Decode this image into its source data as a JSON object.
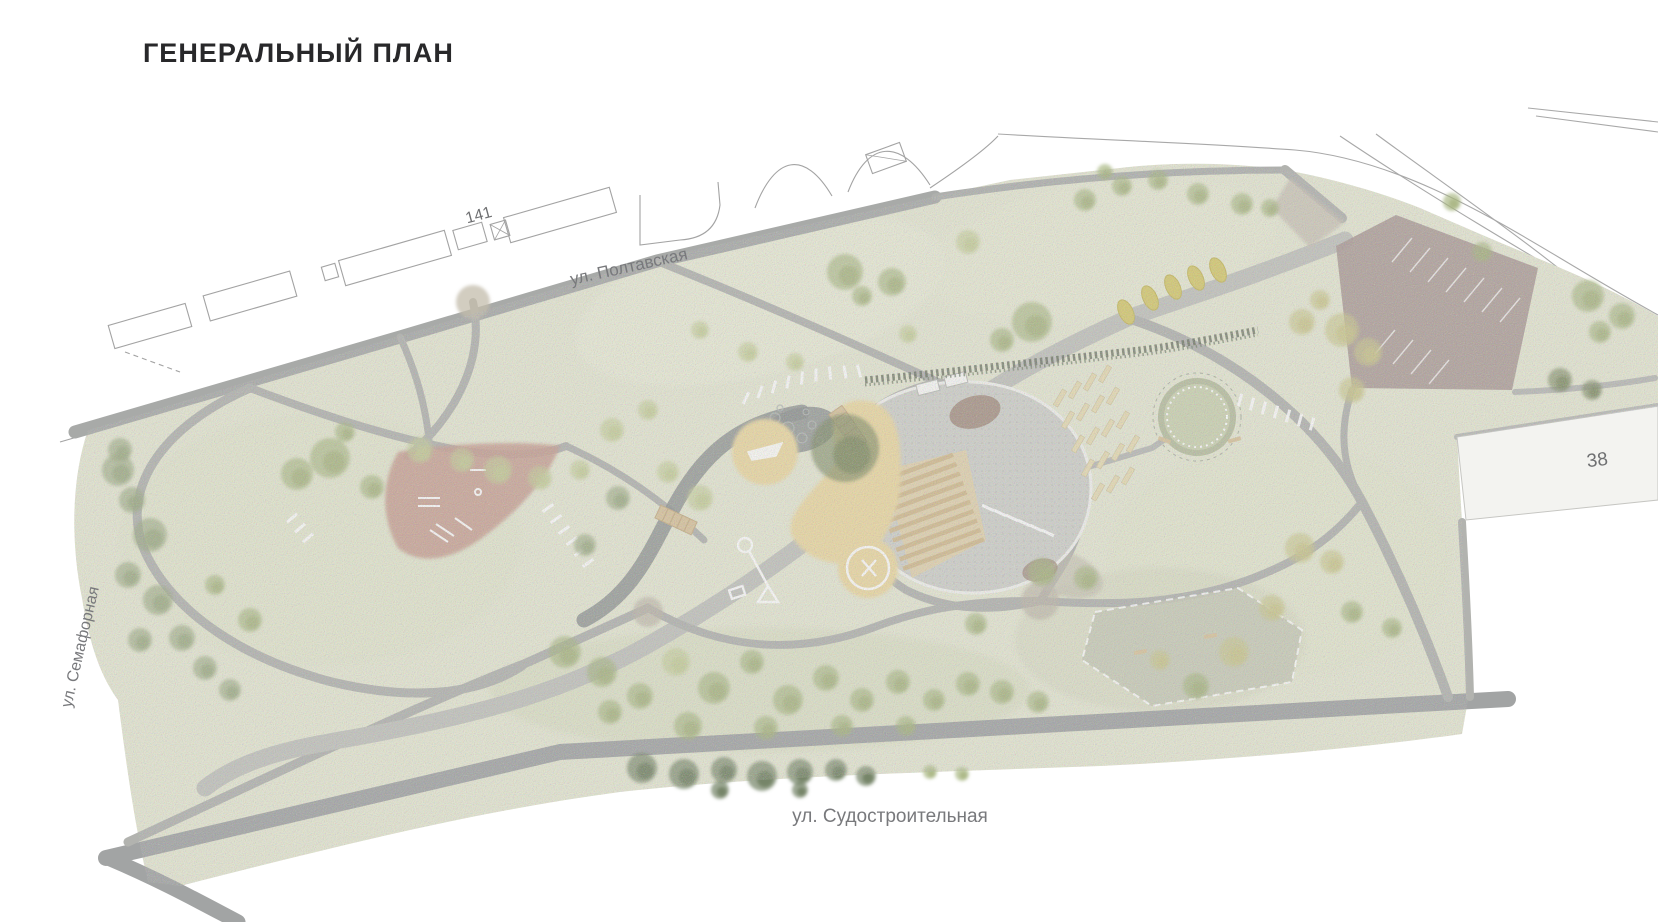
{
  "page": {
    "title": "ГЕНЕРАЛЬНЫЙ ПЛАН"
  },
  "plan": {
    "streets": [
      {
        "id": "poltavskaya",
        "label": "ул. Полтавская"
      },
      {
        "id": "semafornaya",
        "label": "ул. Семафорная"
      },
      {
        "id": "sudostroitelnaya",
        "label": "ул. Судостроительная"
      }
    ],
    "building_numbers": [
      {
        "id": "north-residential-block",
        "label": "141"
      },
      {
        "id": "southeast-building",
        "label": "38"
      }
    ],
    "legend_colors": {
      "lawn": "#e6e8d3",
      "road": "#a8aaa8",
      "promenade": "#c2c3bd",
      "plaza_paving": "#d0d1cb",
      "playground_sand": "#ecd9a2",
      "fitness_surface": "#c89e91",
      "parking": "#ab9a96",
      "amphitheater_wood": "#d2ba8e",
      "dry_creek": "#8d9290",
      "dog_park": "#c7c9b7",
      "tree_dark": "#697a5b"
    }
  }
}
